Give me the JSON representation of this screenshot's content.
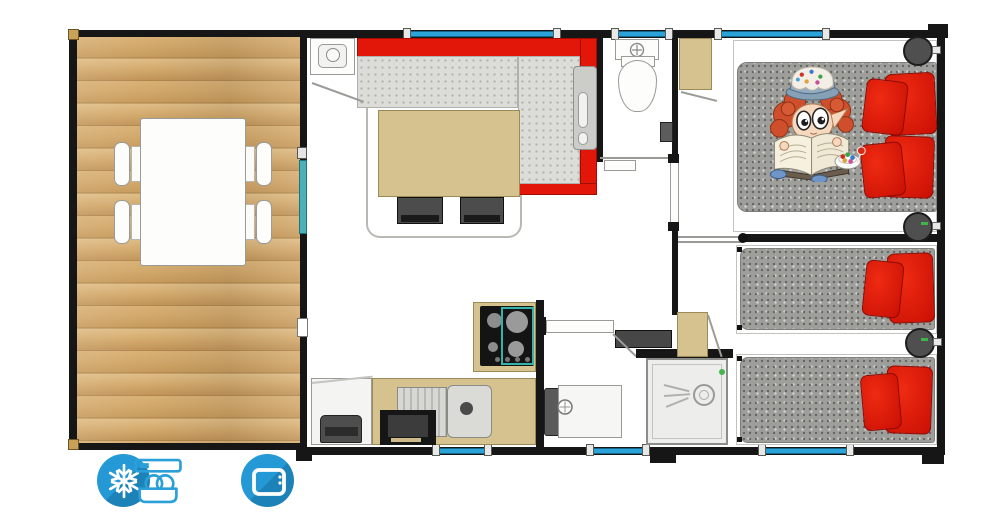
{
  "plan": {
    "kind": "Mobile home floor plan",
    "amenities": [
      {
        "name": "air-conditioning",
        "icon": "snowflake-icon"
      },
      {
        "name": "dishwasher",
        "icon": "dishwasher-icon"
      },
      {
        "name": "television",
        "icon": "tv-icon"
      }
    ],
    "palette": {
      "wall": "#161616",
      "wood_deck": "#cda266",
      "window_blue": "#2ba3d8",
      "sliding_door_teal": "#4ab0ba",
      "sofa_red": "#e2170a",
      "pillow_red": "#d01408",
      "mattress_gray": "#9e9e9b",
      "sofa_seat_gray": "#dcdcd8",
      "furniture_tan": "#d5c28f",
      "amenity_icon_blue": "#2095d2"
    },
    "rooms": [
      "terrace",
      "living-room",
      "kitchen",
      "wc",
      "shower-room",
      "hallway",
      "double-bedroom",
      "twin-bedroom"
    ],
    "furniture": [
      "dining-table",
      "garden-chairs",
      "corner-sofa",
      "coffee-table",
      "stools",
      "water-heater",
      "gas-hob",
      "kitchen-sink",
      "fridge",
      "oven",
      "toilet",
      "hand-basin",
      "washbasin",
      "shower",
      "wardrobe",
      "storage-cabinet",
      "double-bed",
      "single-bed",
      "nightstand",
      "red-pillows",
      "reading-child-illustration",
      "candy-bowl"
    ]
  }
}
